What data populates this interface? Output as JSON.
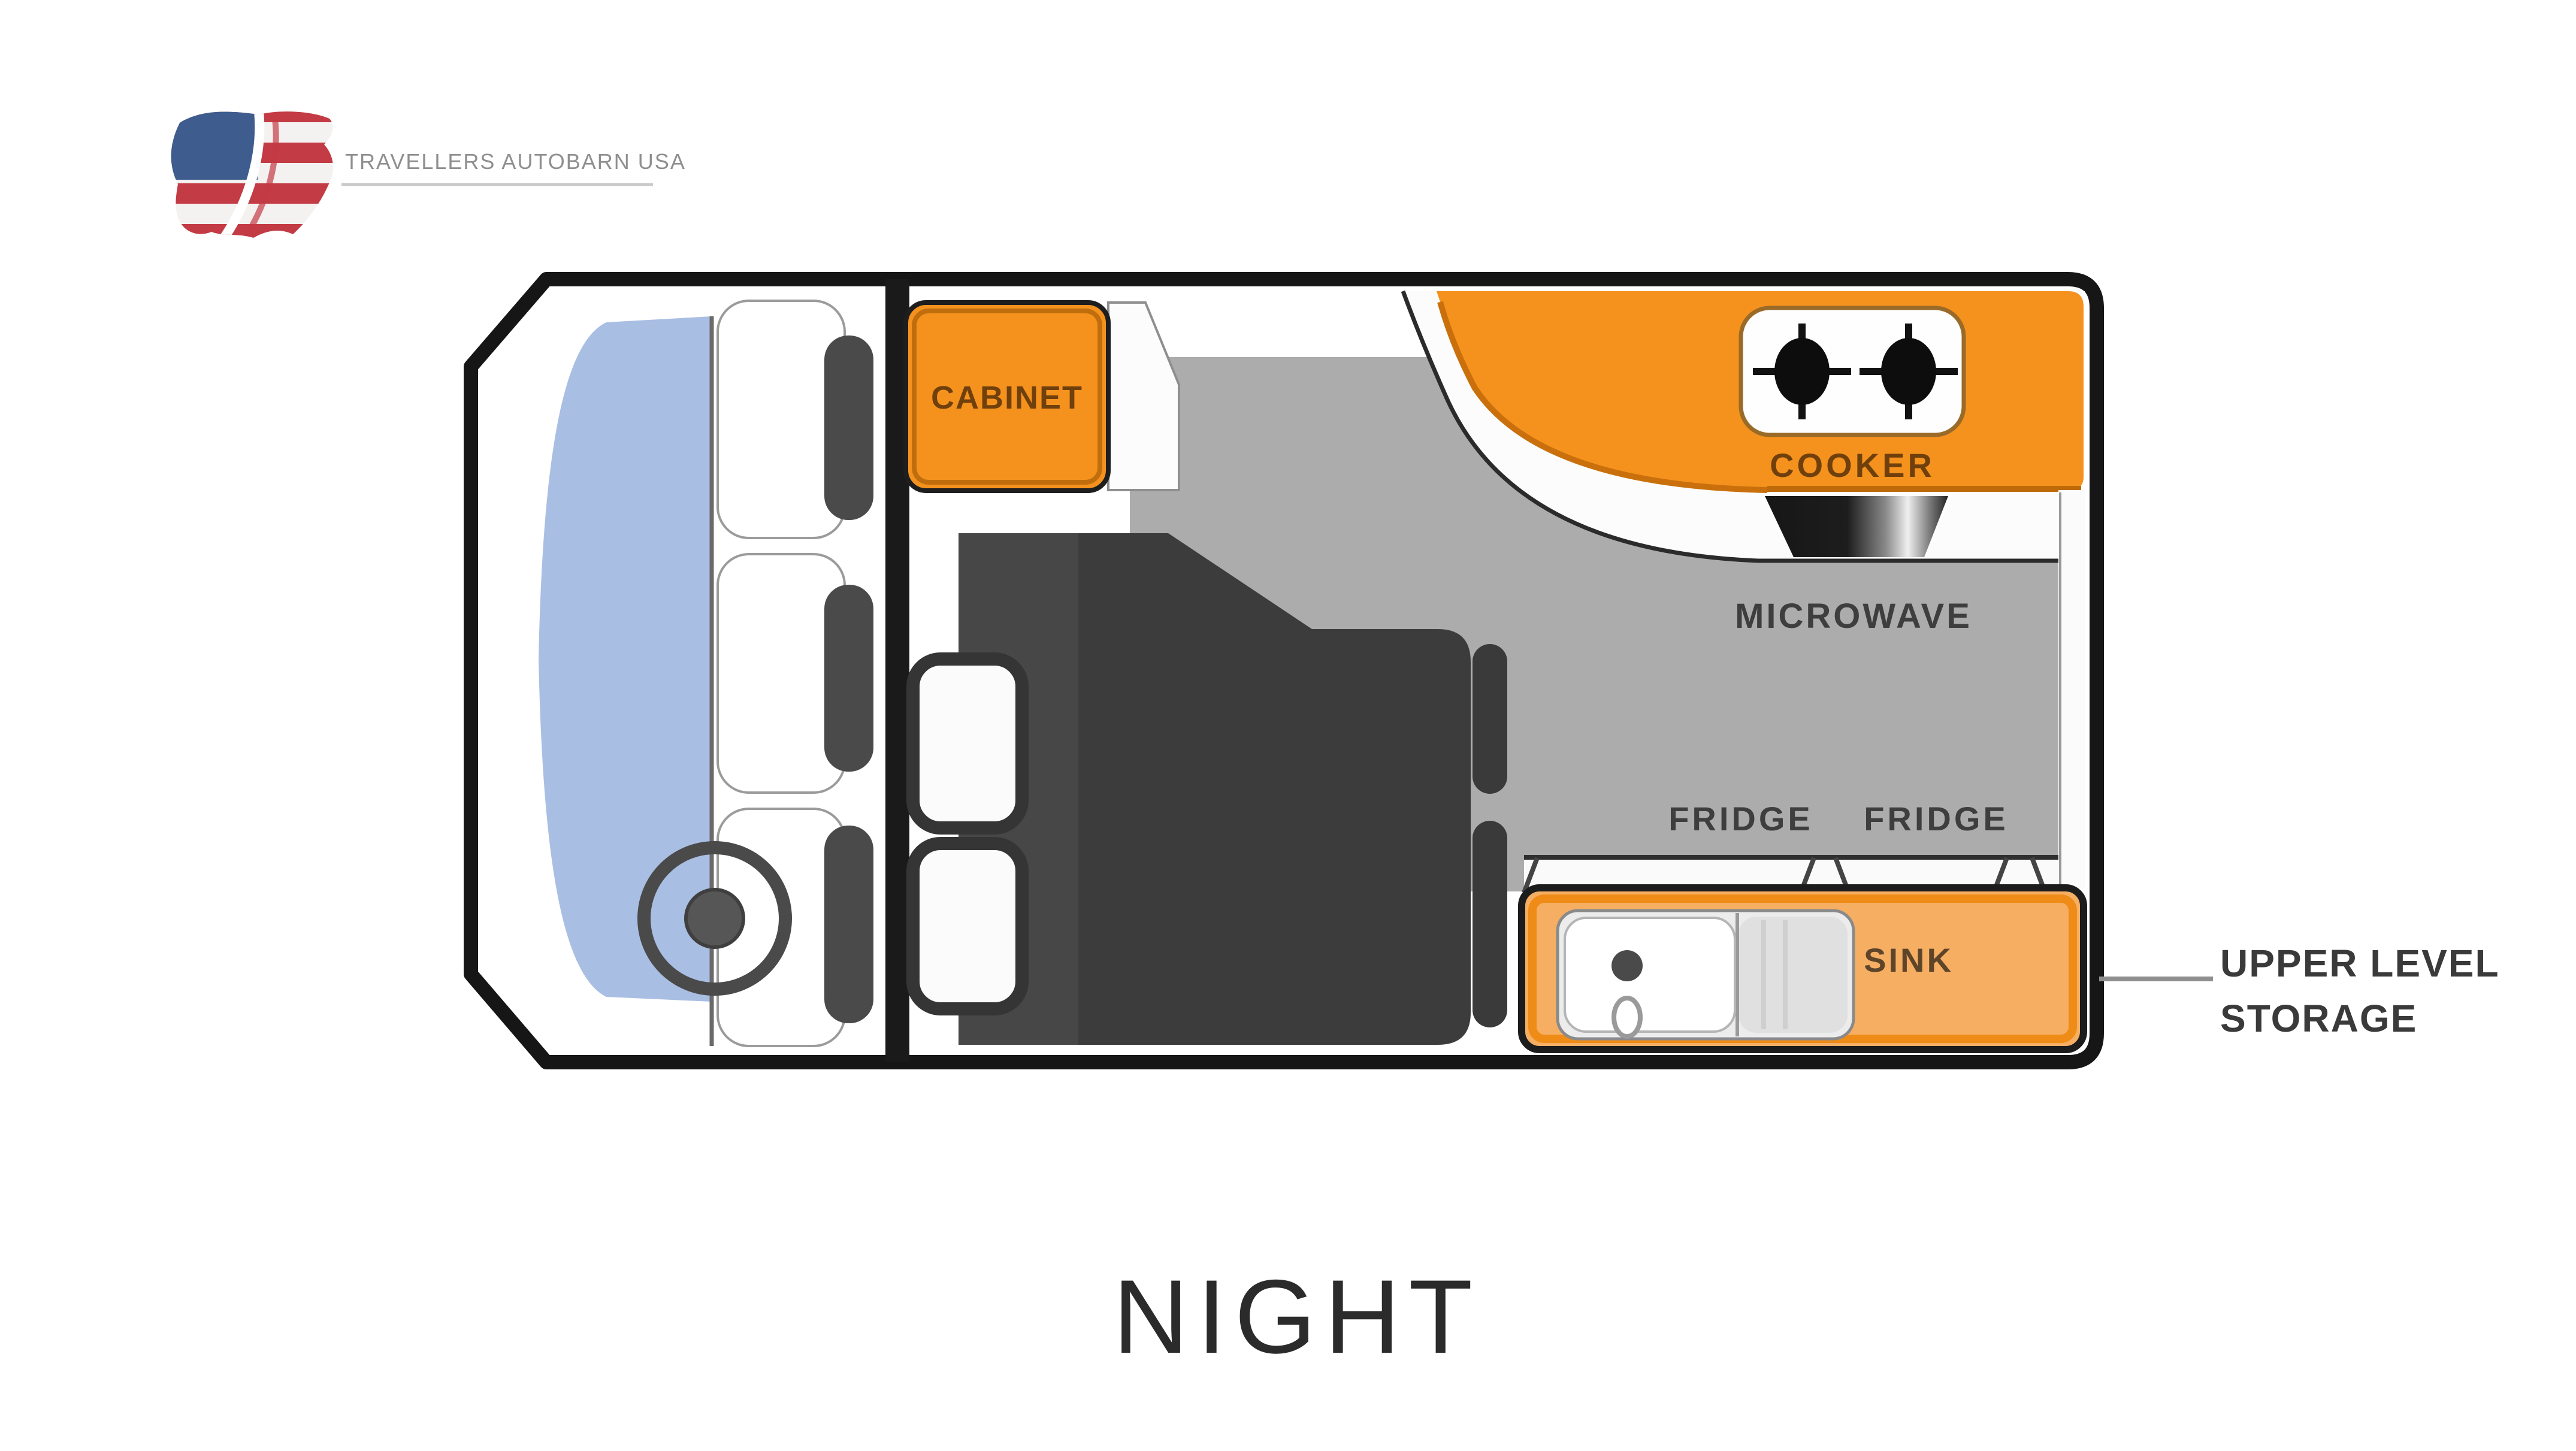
{
  "logo": {
    "brand_text": "TRAVELLERS AUTOBARN USA",
    "flag_icon": "us-flag-map-icon"
  },
  "floorplan": {
    "labels": {
      "cabinet": "CABINET",
      "cooker": "COOKER",
      "microwave": "MICROWAVE",
      "fridge_left": "FRIDGE",
      "fridge_right": "FRIDGE",
      "sink": "SINK"
    },
    "callout": {
      "line1": "UPPER LEVEL",
      "line2": "STORAGE"
    },
    "colors": {
      "counter_orange": "#F5921E",
      "sink_counter_orange": "#F6AE63",
      "floor_gray": "#ACACAC",
      "bed_dark": "#3C3C3C",
      "windshield_blue": "#A9BEE3",
      "outline_black": "#161616",
      "label_dark": "#3E3E3E",
      "label_brown": "#70400C",
      "flag_red": "#C33B44",
      "flag_blue": "#3E5C8E"
    }
  },
  "title": {
    "text": "NIGHT"
  }
}
